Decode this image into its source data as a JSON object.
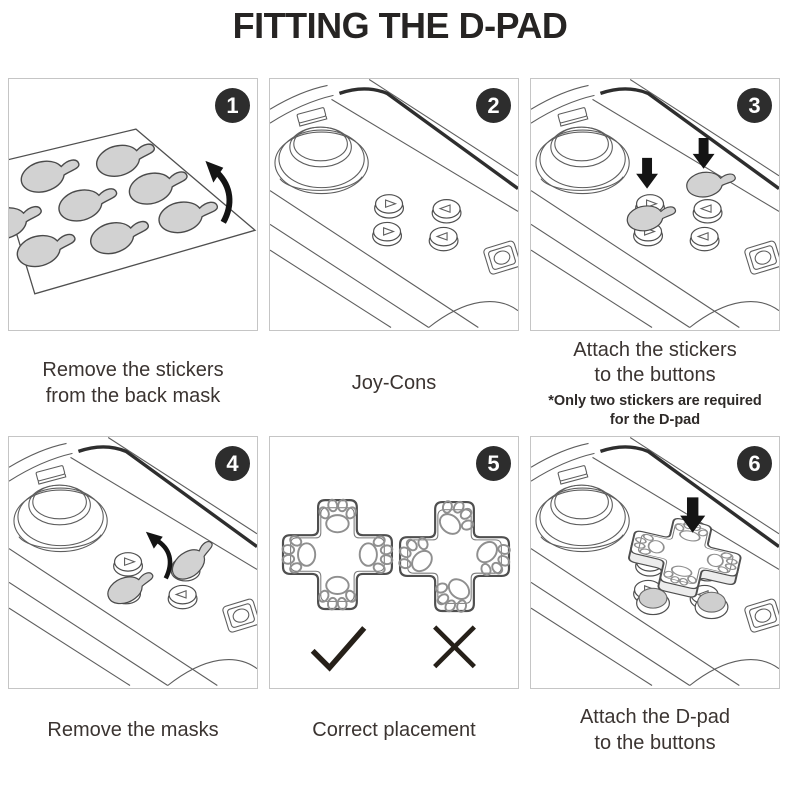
{
  "title": "FITTING THE D-PAD",
  "colors": {
    "badge": "#2d2d2d",
    "panel_border": "#c5c5c5",
    "line_art": "#5e5e5e",
    "sticker_fill": "#d2d2d2",
    "caption_text": "#3b3431",
    "arrow": "#141414"
  },
  "icons": {
    "checkmark": "✓",
    "x_mark": "✕",
    "down_arrow": "▼",
    "curved_arrow": "⤴",
    "paw_print": "🐾",
    "step_badge": "numbered-dark-circle"
  },
  "steps": [
    {
      "number": "1",
      "caption_lines": [
        "Remove the stickers",
        "from the back mask"
      ]
    },
    {
      "number": "2",
      "caption_lines": [
        "Joy-Cons"
      ]
    },
    {
      "number": "3",
      "caption_lines": [
        "Attach the stickers",
        "to the buttons"
      ],
      "note_lines": [
        "*Only two stickers are required",
        "for the D-pad"
      ]
    },
    {
      "number": "4",
      "caption_lines": [
        "Remove the masks"
      ]
    },
    {
      "number": "5",
      "caption_lines": [
        "Correct placement"
      ]
    },
    {
      "number": "6",
      "caption_lines": [
        "Attach the D-pad",
        "to the buttons"
      ]
    }
  ]
}
